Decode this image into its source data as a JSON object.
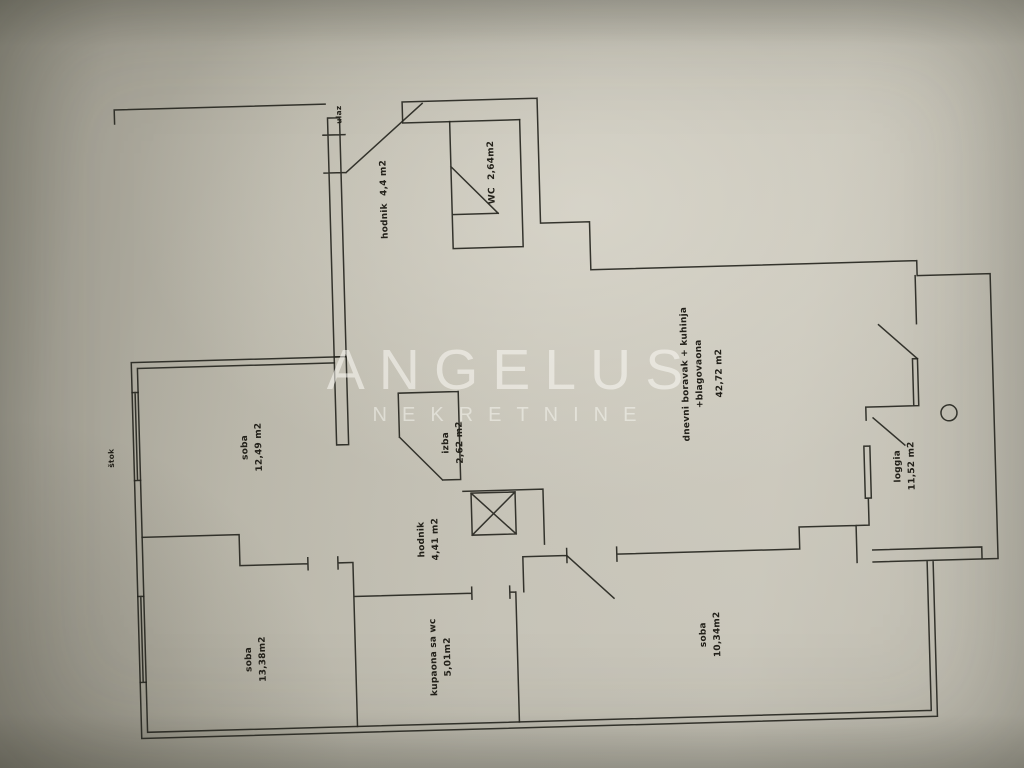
{
  "watermark": {
    "brand": "ANGELUS",
    "subtitle": "NEKRETNINE"
  },
  "plan": {
    "annotations": {
      "door_frame": "štok",
      "entrance": "ulaz"
    },
    "rooms": [
      {
        "id": "hodnik-ulaz",
        "name": "hodnik",
        "area": "4,4 m2"
      },
      {
        "id": "wc",
        "name": "WC",
        "area": "2,64m2"
      },
      {
        "id": "soba-1",
        "name": "soba",
        "area": "12,49 m2"
      },
      {
        "id": "izba",
        "name": "izba",
        "area": "2,62 m2"
      },
      {
        "id": "hodnik",
        "name": "hodnik",
        "area": "4,41 m2"
      },
      {
        "id": "soba-2",
        "name": "soba",
        "area": "13,38m2"
      },
      {
        "id": "kupaona",
        "name": "kupaona sa wc",
        "area": "5,01m2"
      },
      {
        "id": "dnevni-boravak",
        "name": "dnevni boravak + kuhinja",
        "name_line2": "+blagovaona",
        "area": "42,72 m2"
      },
      {
        "id": "soba-3",
        "name": "soba",
        "area": "10,34m2"
      },
      {
        "id": "loggia",
        "name": "loggia",
        "area": "11,52 m2"
      }
    ]
  },
  "colors": {
    "paper": "#bfbcb0",
    "ink": "#26261f",
    "watermark_text": "#f5f4ef"
  }
}
